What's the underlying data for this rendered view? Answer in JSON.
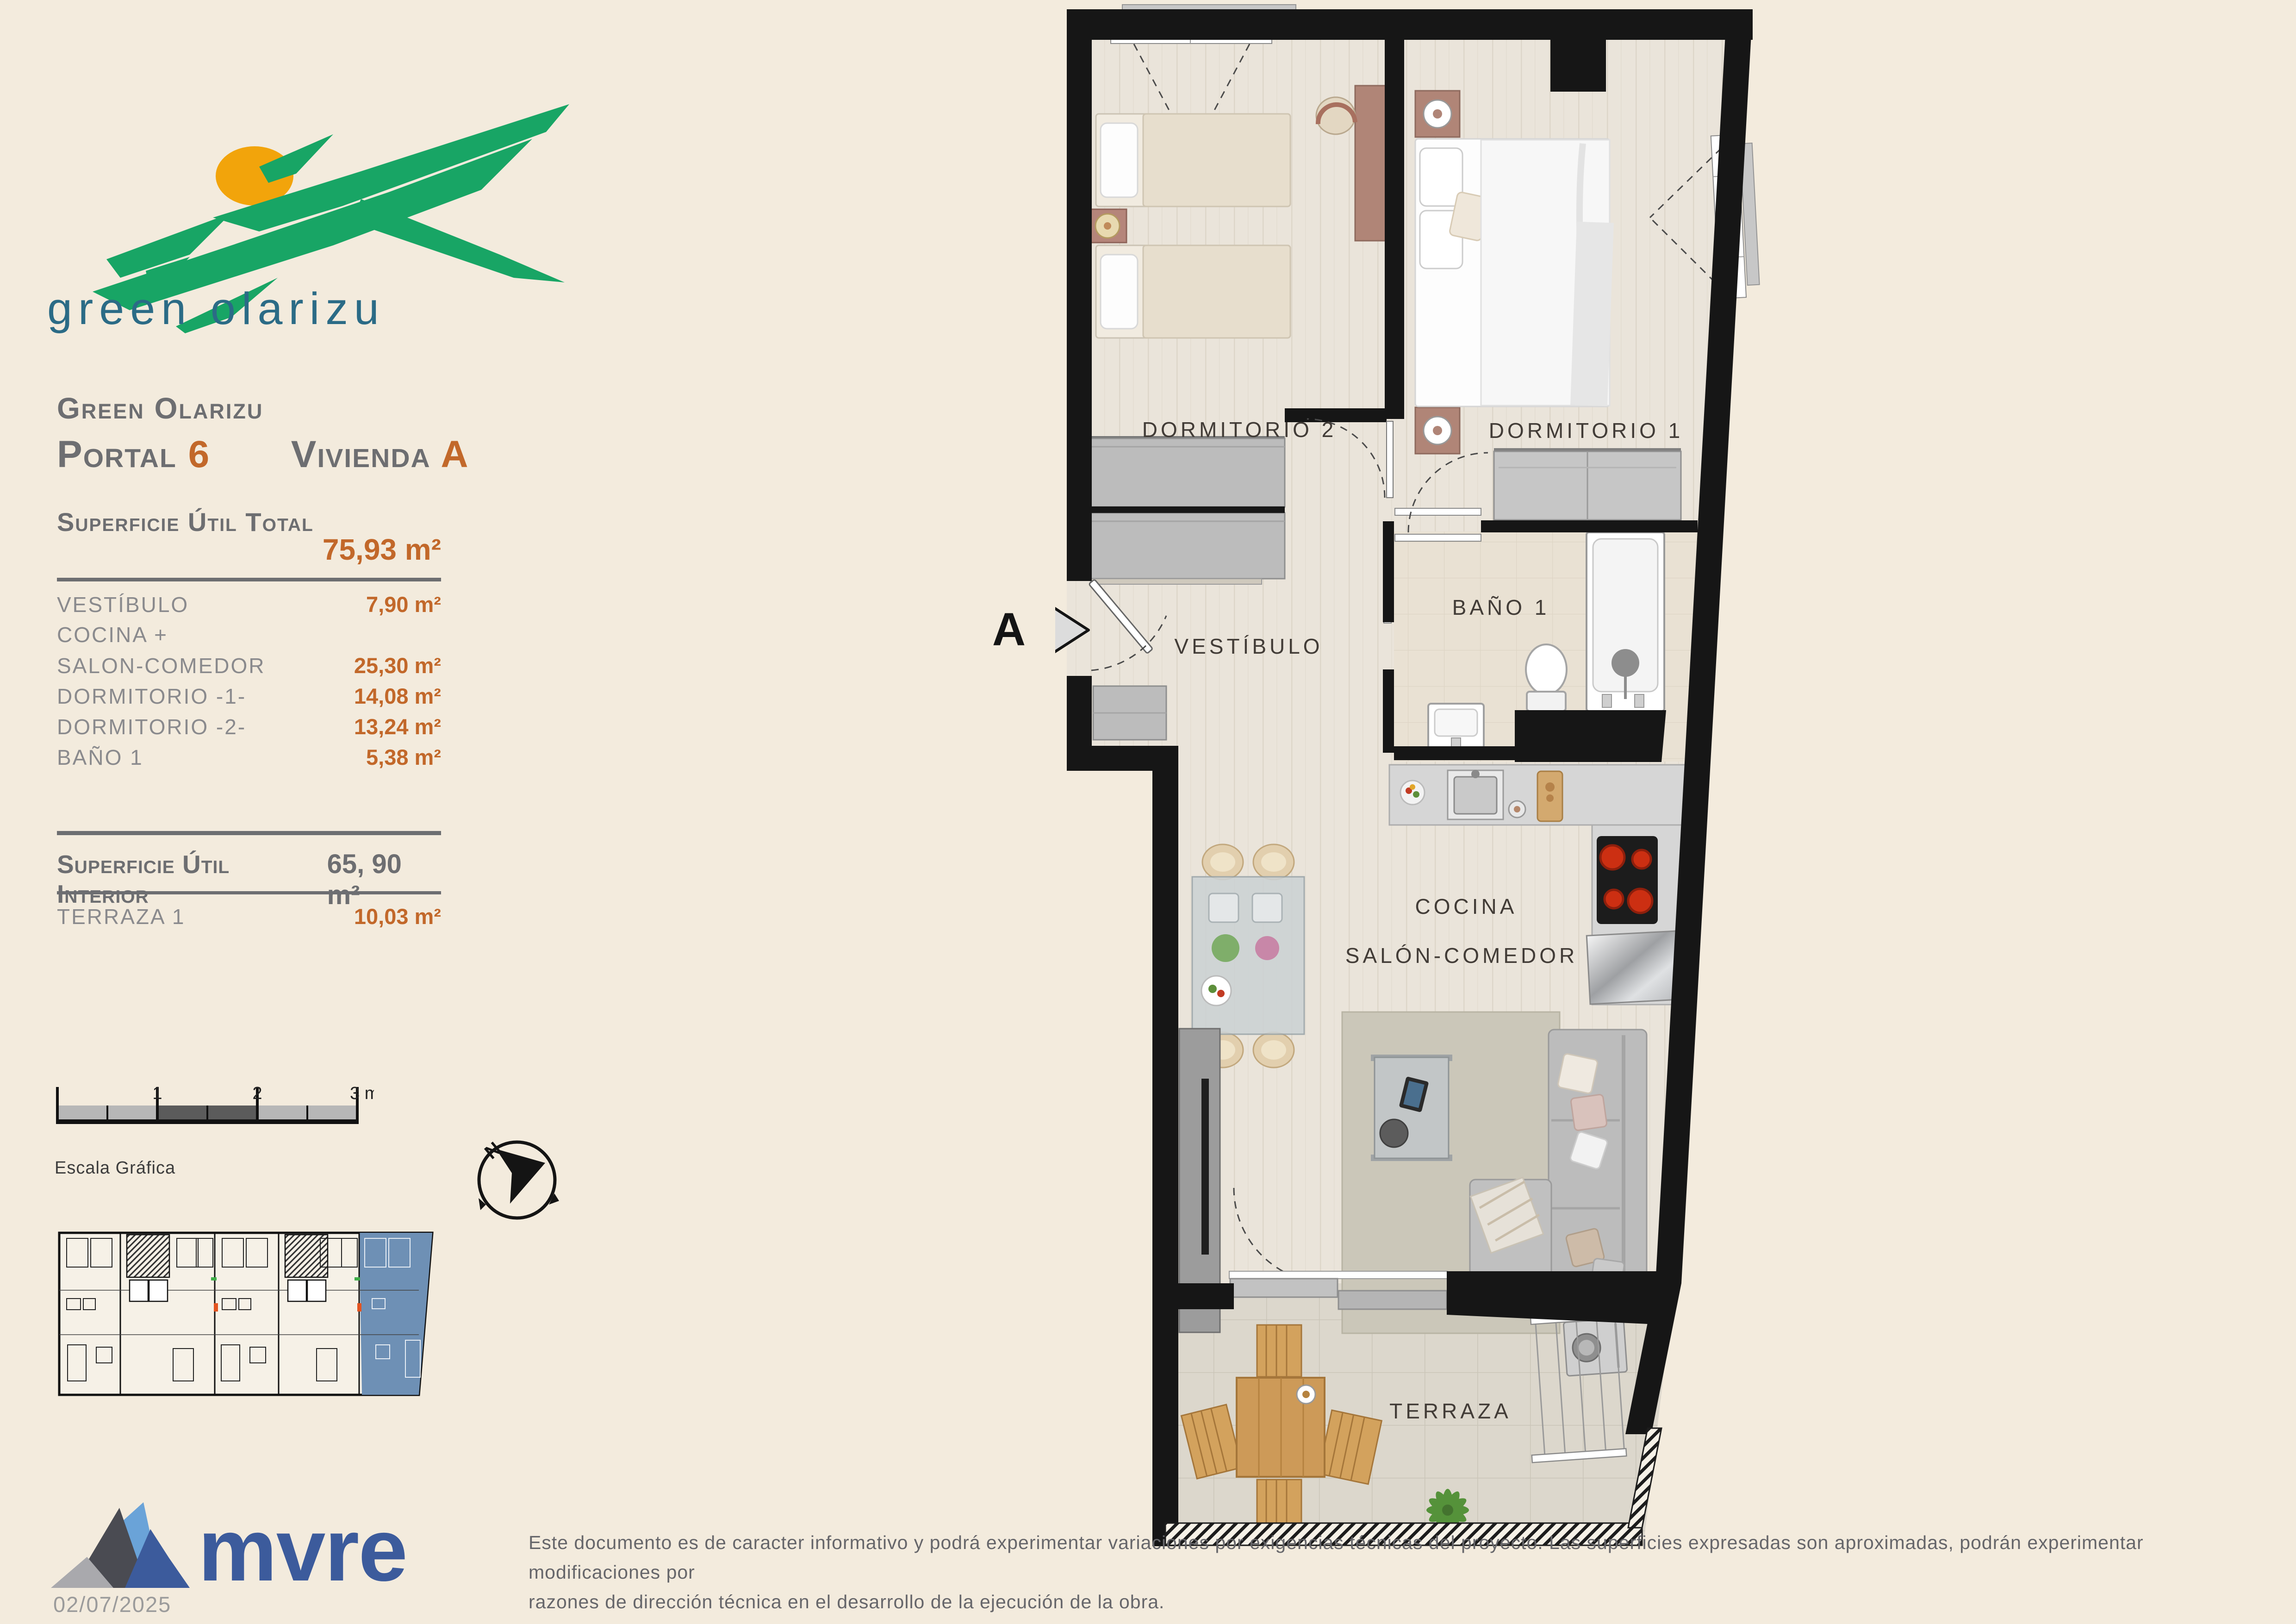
{
  "brand": {
    "logo_text": "green olarizu"
  },
  "header": {
    "project": "Green Olarizu",
    "portal_label": "Portal",
    "portal_value": "6",
    "vivienda_label": "Vivienda",
    "vivienda_value": "A"
  },
  "total": {
    "label": "Superficie Útil Total",
    "value": "75,93 m²"
  },
  "rooms": [
    {
      "label": "VESTÍBULO",
      "value": "7,90 m²"
    },
    {
      "label": "COCINA +",
      "value": ""
    },
    {
      "label": "SALON-COMEDOR",
      "value": "25,30 m²"
    },
    {
      "label": "DORMITORIO -1-",
      "value": "14,08 m²"
    },
    {
      "label": "DORMITORIO -2-",
      "value": "13,24 m²"
    },
    {
      "label": "BAÑO 1",
      "value": "5,38 m²"
    }
  ],
  "interior": {
    "label": "Superficie Útil Interior",
    "value": "65, 90 m²"
  },
  "terrace_row": {
    "label": "TERRAZA 1",
    "value": "10,03 m²"
  },
  "scalebar": {
    "t1": "1",
    "t2": "2",
    "t3": "3 m.",
    "caption": "Escala Gráfica"
  },
  "compass": {
    "n": "N"
  },
  "plan": {
    "labels": {
      "dormitorio2": "DORMITORIO 2",
      "dormitorio1": "DORMITORIO 1",
      "bano1": "BAÑO 1",
      "vestibulo": "VESTÍBULO",
      "cocina": "COCINA",
      "salon": "SALÓN-COMEDOR",
      "terraza": "TERRAZA"
    },
    "section_marker": "A"
  },
  "footer": {
    "logo_text": "mvre",
    "date": "02/07/2025",
    "disclaimer_line1": "Este documento es de caracter informativo y podrá experimentar variaciones por exigencias técnicas del proyecto. Las superficies expresadas son aproximadas, podrán experimentar modificaciones por",
    "disclaimer_line2": "razones de dirección técnica en el desarrollo de la ejecución de la obra."
  },
  "colors": {
    "accent_orange": "#c2682a",
    "heading_gray": "#6d6e71",
    "list_gray": "#8a8a8d",
    "unit_highlight": "#6e90b5",
    "logo_green": "#18a565",
    "logo_sun": "#f2a40b",
    "logo_teal": "#2b6b86",
    "mvre_blue": "#3c5b9c",
    "wall_black": "#161616"
  }
}
